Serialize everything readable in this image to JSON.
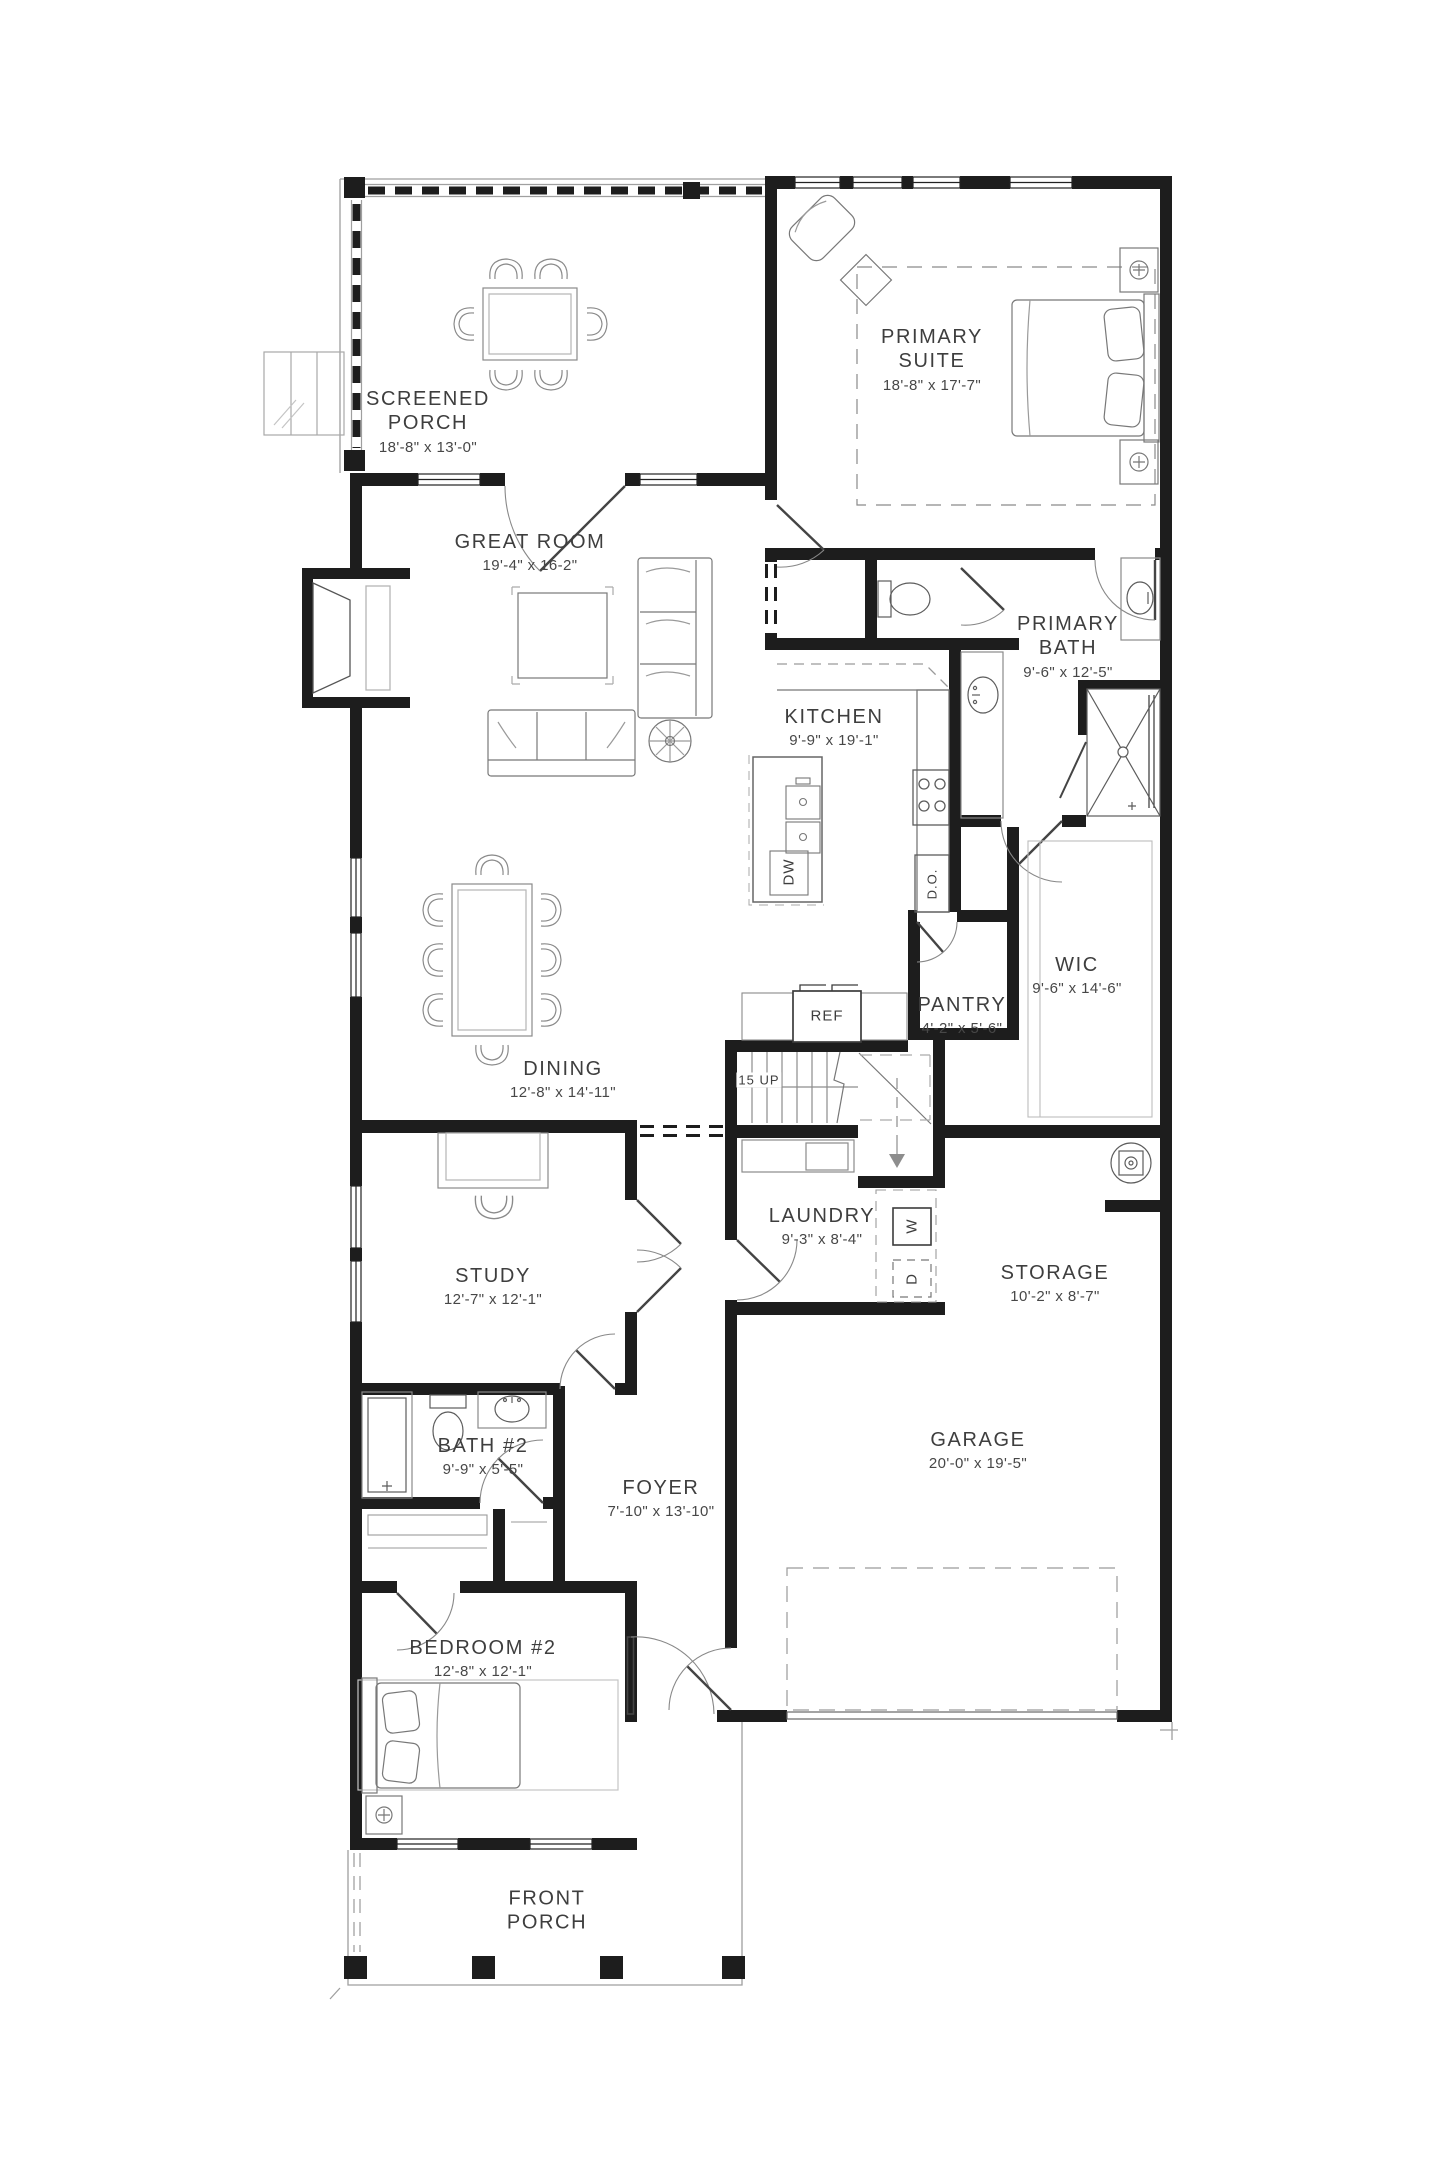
{
  "plan": {
    "rooms": [
      {
        "id": "screened-porch",
        "line1": "SCREENED",
        "line2": "PORCH",
        "dims": "18'-8\" x 13'-0\""
      },
      {
        "id": "primary-suite",
        "line1": "PRIMARY",
        "line2": "SUITE",
        "dims": "18'-8\" x 17'-7\""
      },
      {
        "id": "great-room",
        "line1": "GREAT ROOM",
        "dims": "19'-4\" x 16-2\""
      },
      {
        "id": "kitchen",
        "line1": "KITCHEN",
        "dims": "9'-9\" x 19'-1\""
      },
      {
        "id": "primary-bath",
        "line1": "PRIMARY",
        "line2": "BATH",
        "dims": "9'-6\" x 12'-5\""
      },
      {
        "id": "wic",
        "line1": "WIC",
        "dims": "9'-6\" x 14'-6\""
      },
      {
        "id": "pantry",
        "line1": "PANTRY",
        "dims": "4'-2\" x 5'-6\""
      },
      {
        "id": "dining",
        "line1": "DINING",
        "dims": "12'-8\" x 14'-11\""
      },
      {
        "id": "laundry",
        "line1": "LAUNDRY",
        "dims": "9'-3\" x 8'-4\""
      },
      {
        "id": "study",
        "line1": "STUDY",
        "dims": "12'-7\" x 12'-1\""
      },
      {
        "id": "storage",
        "line1": "STORAGE",
        "dims": "10'-2\" x 8'-7\""
      },
      {
        "id": "bath-2",
        "line1": "BATH #2",
        "dims": "9'-9\" x 5'-5\""
      },
      {
        "id": "foyer",
        "line1": "FOYER",
        "dims": "7'-10\" x 13'-10\""
      },
      {
        "id": "garage",
        "line1": "GARAGE",
        "dims": "20'-0\" x 19'-5\""
      },
      {
        "id": "bedroom-2",
        "line1": "BEDROOM #2",
        "dims": "12'-8\" x 12'-1\""
      },
      {
        "id": "front-porch",
        "line1": "FRONT",
        "line2": "PORCH"
      }
    ],
    "features": {
      "refrigerator": "REF",
      "stairs": "15 UP",
      "dishwasher": "DW",
      "double_oven": "D.O.",
      "washer": "W",
      "dryer": "D"
    },
    "colors": {
      "wall": "#1d1d1d",
      "furniture": "#6e6e6e",
      "text": "#3e3e3e"
    }
  }
}
